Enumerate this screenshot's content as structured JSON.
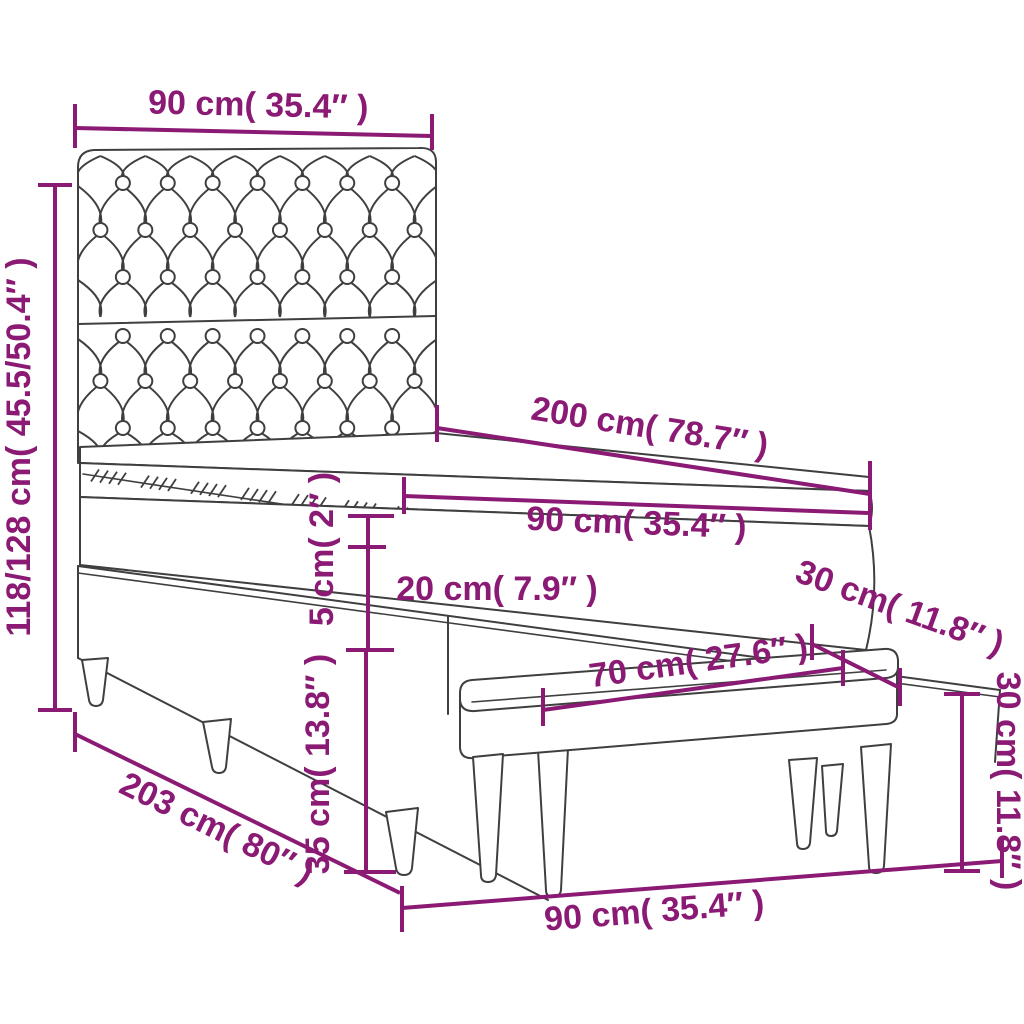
{
  "page": {
    "background": "#ffffff"
  },
  "diagram": {
    "type": "product-dimension-diagram",
    "subject": "box spring bed with tufted headboard, mattress topper and bench",
    "accent_color": "#8a1a73",
    "line_color": "#3f3f3f",
    "labels": {
      "headboard_width": "90 cm( 35.4″ )",
      "bed_height": "118/128 cm( 45.5/50.4″ )",
      "bed_length": "200 cm( 78.7″ )",
      "mattress_width": "90 cm( 35.4″ )",
      "topper_thickness": "5 cm( 2″ )",
      "mattress_thickness": "20 cm( 7.9″ )",
      "base_height": "35 cm( 13.8″ )",
      "bench_depth": "30 cm( 11.8″ )",
      "bench_length": "70 cm( 27.6″ )",
      "bench_height": "30 cm( 11.8″ )",
      "total_length": "203 cm( 80″ )",
      "bed_width": "90 cm( 35.4″ )"
    }
  }
}
